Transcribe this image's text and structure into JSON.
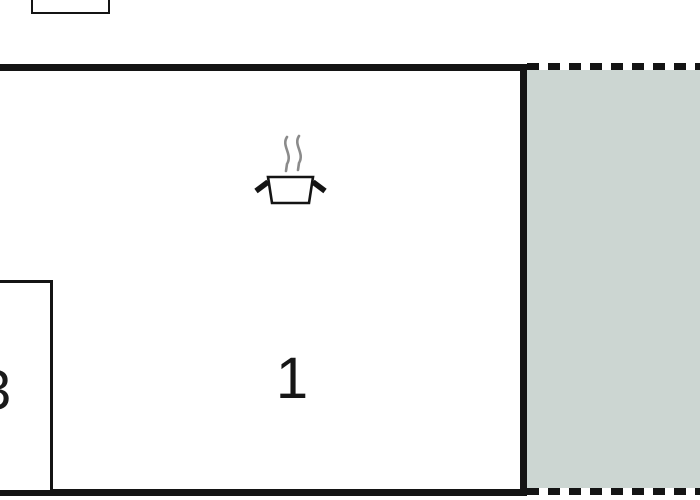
{
  "floorplan": {
    "rooms": [
      {
        "id": "room-1",
        "label": "1",
        "note": "main room with cooking-pot symbol (kitchen)"
      },
      {
        "id": "room-adjacent",
        "label": "3",
        "note": "adjacent room, mostly clipped at left edge"
      }
    ],
    "terrace": {
      "note": "shaded outdoor area on right, dashed boundary"
    },
    "icons": [
      {
        "name": "cooking-pot-icon",
        "meaning": "kitchen / cooking plate"
      },
      {
        "name": "steam-icon",
        "meaning": "steam above pot"
      }
    ]
  },
  "colors": {
    "wall": "#141414",
    "terrace_fill": "#ccd6d2",
    "steam": "#8b8b8b",
    "background": "#ffffff"
  }
}
